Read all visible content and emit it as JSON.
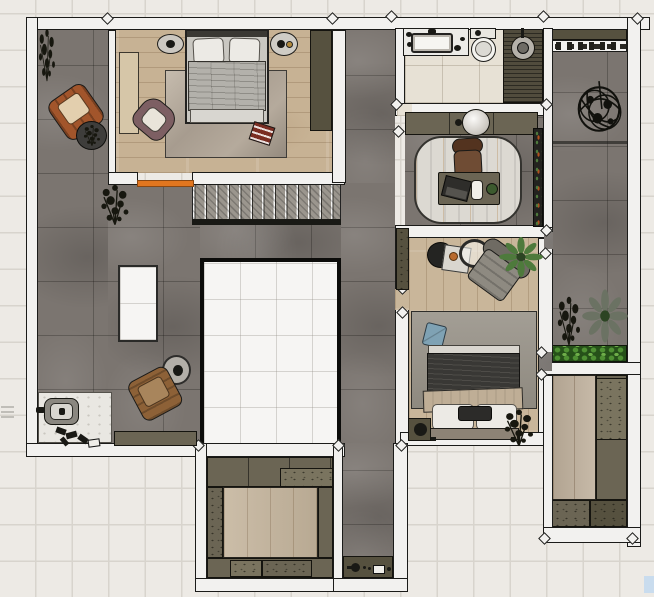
{
  "scene": {
    "kind": "architectural floor plan, top-down textured render",
    "level": "upper floor",
    "visible_text": ""
  },
  "palette": {
    "bg": "#edeae5",
    "bg_grid": "#d8d4cd",
    "wall": "#f2f1ef",
    "line": "#1b1b19",
    "concrete": "#7b7570",
    "wood_bedroom1": "#c7b294",
    "wood_bedroom2": "#c9b69a",
    "wood_closet": "#c4b49c",
    "wood_right_room": "#bfb09c",
    "tile_bath": "#e7e1d5",
    "teak": "#514c3d",
    "olive": "#6b6554",
    "olive_dark": "#56513f",
    "olive_light": "#7a745f",
    "void_fill": "#f6f5f3",
    "stair": "#9b968e",
    "rug_study": "#dcd9d2",
    "duvet_gray": "#b3b1ab",
    "duvet_dark": "#393835",
    "blanket": "#bfae96",
    "pillow": "#eceae5",
    "chair_orange": "#a2552b",
    "chair_brown": "#8d6137",
    "chair_mauve": "#7d5f63",
    "chair_gray": "#8e8a81",
    "chair_desk": "#6f4c34",
    "accent_orange": "#e2761e",
    "cushion_blue": "#7fa2b4",
    "tray_red": "#7a2d22",
    "plant_green": "#4e7a3c",
    "plant_gray_green": "#6b7263",
    "plant_dark": "#17170f",
    "hedge_green": "#3f7a2e",
    "note_blue": "#c9dcee"
  },
  "rooms": [
    {
      "id": "hall",
      "features": [
        "stairwell-void",
        "skylight-void",
        "stairs",
        "lounge-chairs"
      ]
    },
    {
      "id": "bedroom-1",
      "furniture": [
        "double-bed",
        "two-nightstands",
        "rug",
        "mauve-armchair",
        "wardrobe",
        "window-bench",
        "red-tray"
      ]
    },
    {
      "id": "bathroom",
      "furniture": [
        "vanity-sink",
        "toilet",
        "teak-shower-deck"
      ]
    },
    {
      "id": "study",
      "furniture": [
        "basin-console",
        "desk",
        "desk-chair",
        "laptop",
        "cup",
        "desk-plant",
        "rug",
        "window-planter"
      ]
    },
    {
      "id": "bedroom-2",
      "furniture": [
        "double-bed",
        "rug",
        "blue-cushion",
        "gray-armchair",
        "coffee-table-set",
        "wardrobe",
        "nightstand",
        "plants"
      ]
    },
    {
      "id": "walk-in-closet",
      "furniture": [
        "perimeter-cabinets",
        "wood-island-floor"
      ]
    },
    {
      "id": "rear-corridor",
      "furniture": [
        "console-with-kettle"
      ]
    },
    {
      "id": "terrace-right",
      "furniture": [
        "potted-tree",
        "potted-plants",
        "hedge-planter",
        "top-shelf"
      ]
    },
    {
      "id": "storage-room",
      "furniture": [
        "tall-cabinets",
        "low-cabinets"
      ]
    },
    {
      "id": "entry-nook",
      "furniture": [
        "floor-fixture",
        "scattered-shoes",
        "sideboard"
      ]
    }
  ],
  "stairs": {
    "tread_count": 13,
    "orientation": "horizontal"
  },
  "accents": {
    "door_threshold": "orange",
    "bed_cushion": "blue",
    "bedroom1_tray": "red"
  }
}
